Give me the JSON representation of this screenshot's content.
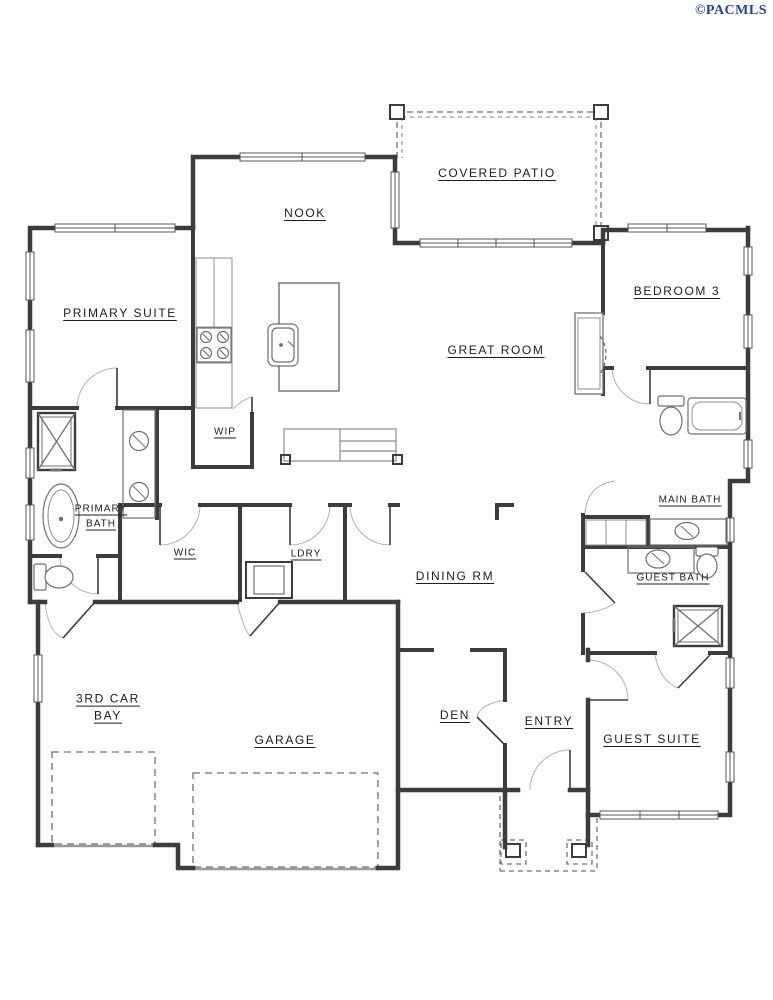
{
  "watermark": "©PACMLS",
  "colors": {
    "wall": "#3c3c3c",
    "thin": "#8c8c8c",
    "fixture": "#6f6f6f",
    "swing": "#b0b0b0",
    "dash": "#707070",
    "sill": "#9a9a9a",
    "watermark_blue": "#27418f"
  },
  "rooms": {
    "covered_patio": "COVERED PATIO",
    "nook": "NOOK",
    "primary_suite": "PRIMARY SUITE",
    "bedroom3": "BEDROOM 3",
    "great_room": "GREAT ROOM",
    "wip": "WIP",
    "primary_bath": "PRIMARY BATH",
    "main_bath": "MAIN BATH",
    "wic": "WIC",
    "ldry": "LDRY",
    "guest_bath": "GUEST BATH",
    "dining": "DINING RM",
    "third_car_bay": "3RD CAR BAY",
    "garage": "GARAGE",
    "den": "DEN",
    "entry": "ENTRY",
    "guest_suite": "GUEST SUITE"
  }
}
